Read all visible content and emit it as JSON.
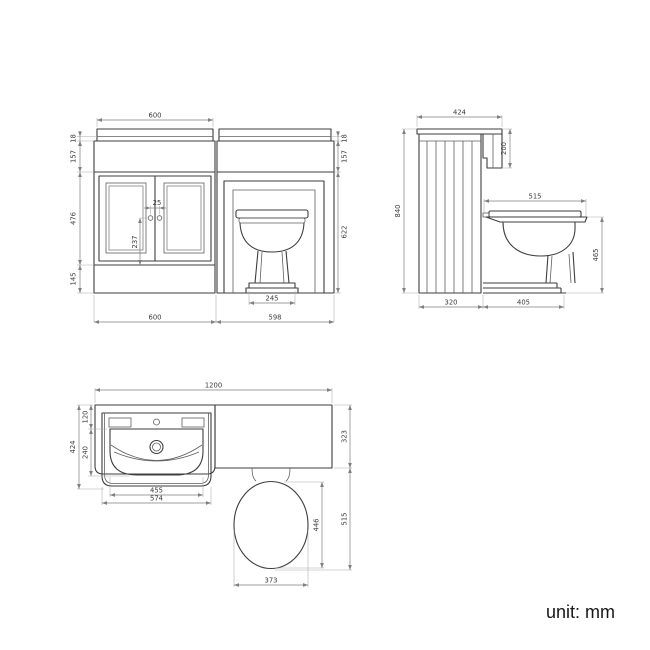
{
  "unit_label": "unit: mm",
  "front": {
    "top_width": "600",
    "worktop_thickness_left": "18",
    "upper_band_left": "157",
    "door_height": "476",
    "plinth_height": "145",
    "handle_spacing": "25",
    "handle_drop": "237",
    "pan_base_width": "245",
    "vanity_width": "600",
    "wc_unit_width": "598",
    "worktop_thickness_right": "18",
    "upper_band_right": "157",
    "wc_opening_height": "622"
  },
  "side": {
    "worktop_depth": "424",
    "cistern_panel_height": "200",
    "total_height": "840",
    "seat_depth": "515",
    "seat_height": "465",
    "cabinet_depth": "320",
    "pan_projection": "405"
  },
  "plan": {
    "total_width": "1200",
    "vanity_depth": "424",
    "basin_back_depth": "120",
    "basin_bowl_depth": "240",
    "basin_inner_width": "455",
    "basin_width": "574",
    "wc_unit_depth": "323",
    "pan_projection": "515",
    "seat_length": "446",
    "seat_width": "373"
  }
}
